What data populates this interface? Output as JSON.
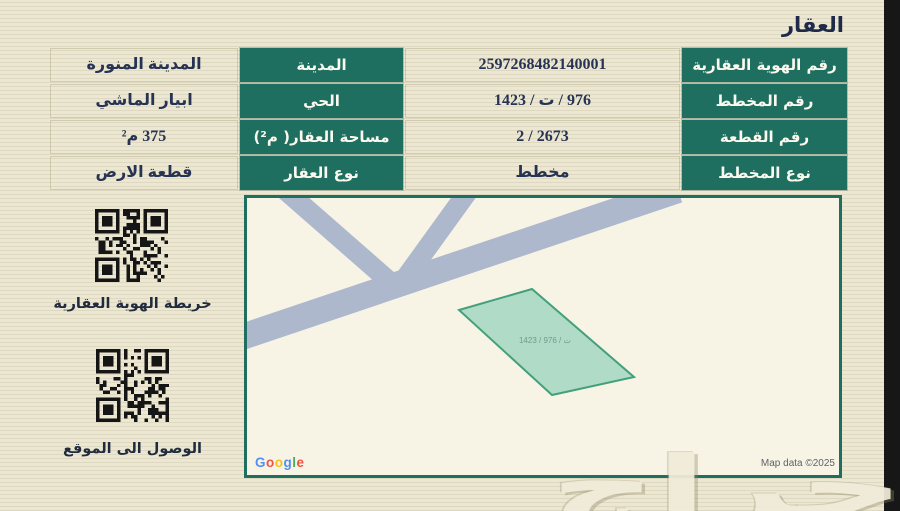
{
  "page": {
    "title": "العقار"
  },
  "table": {
    "rows": [
      {
        "label_right": "رقم الهوية العقارية",
        "value_right": "2597268482140001",
        "label_left": "المدينة",
        "value_left": "المدينة المنورة"
      },
      {
        "label_right": "رقم المخطط",
        "value_right": "976 / ت / 1423",
        "label_left": "الحي",
        "value_left": "ابيار الماشي"
      },
      {
        "label_right": "رقم القطعة",
        "value_right": "2673 / 2",
        "label_left": "مساحة العقار( م²)",
        "value_left": "375 م²"
      },
      {
        "label_right": "نوع المخطط",
        "value_right": "مخطط",
        "label_left": "نوع العقار",
        "value_left": "قطعة الارض"
      }
    ]
  },
  "qr_panel": {
    "items": [
      {
        "label": "خريطة الهوية العقارية"
      },
      {
        "label": "الوصول الى الموقع"
      }
    ]
  },
  "map": {
    "parcel_label": "1423 / ت / 976",
    "attribution": "Map data ©2025",
    "google_letters": [
      "G",
      "o",
      "o",
      "g",
      "l",
      "e"
    ]
  },
  "watermark": {
    "logo_text": "حراج"
  },
  "colors": {
    "accent_green": "#1e6f5f",
    "text_navy": "#273355",
    "page_bg": "#ece7d3",
    "map_bg": "#f7f4e6",
    "road": "#aeb8cd",
    "parcel_fill": "#a6d8c3",
    "parcel_stroke": "#44a07b",
    "edge_strip": "#171717"
  }
}
